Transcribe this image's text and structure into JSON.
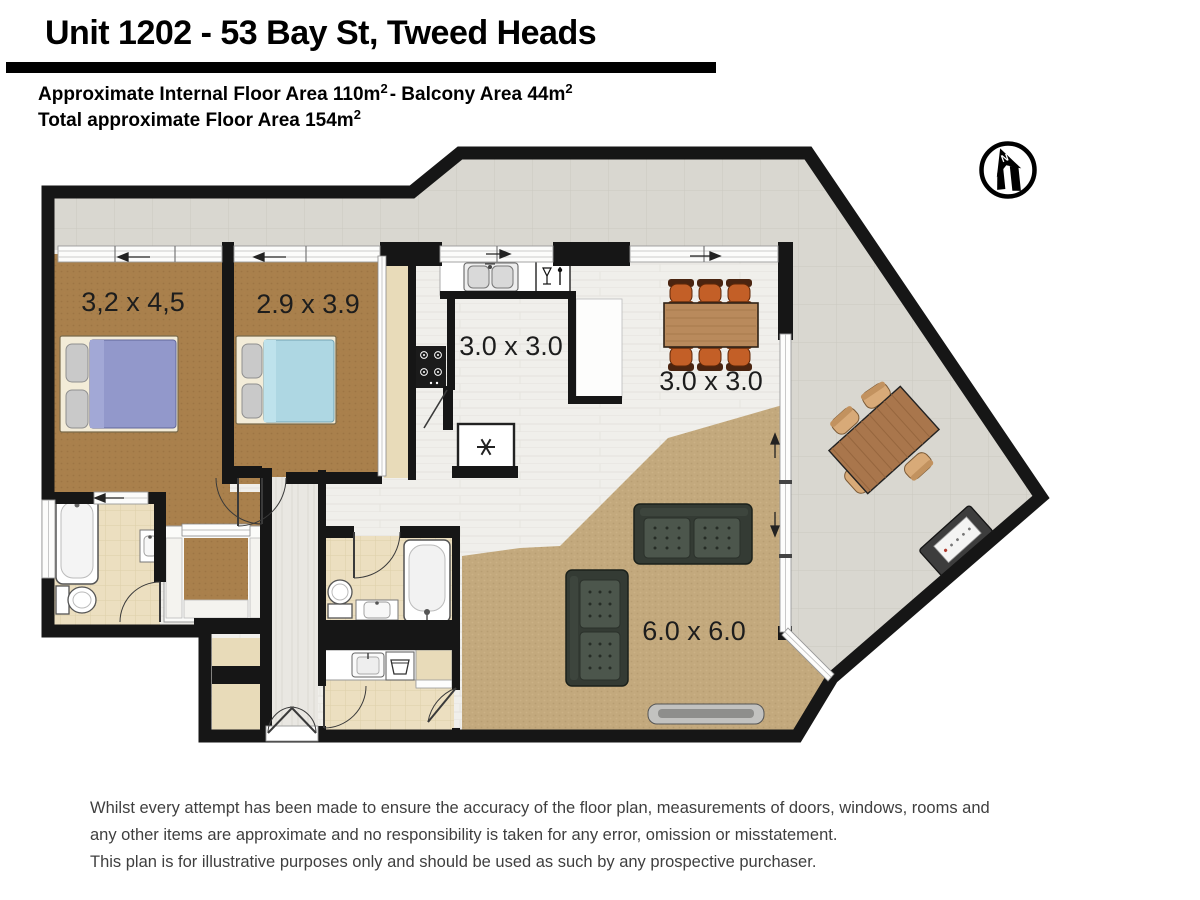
{
  "header": {
    "title": "Unit 1202 - 53 Bay St, Tweed Heads",
    "area_line1": {
      "text": "Approximate Internal Floor Area 110m",
      "sup": "2",
      "text2": "- Balcony Area 44m",
      "sup2": "2"
    },
    "area_line2": {
      "text": "Total approximate Floor Area 154m",
      "sup": "2"
    }
  },
  "plan": {
    "compass_label": "N",
    "rooms": [
      {
        "id": "bedroom-1",
        "label": "3,2 x 4,5"
      },
      {
        "id": "bedroom-2",
        "label": "2.9 x 3.9"
      },
      {
        "id": "kitchen",
        "label": "3.0 x 3.0"
      },
      {
        "id": "dining",
        "label": "3.0 x 3.0"
      },
      {
        "id": "living",
        "label": "6.0 x 6.0"
      }
    ]
  },
  "footer": {
    "disclaimer_lines": [
      "Whilst every attempt has been made to ensure the accuracy of the floor plan, measurements of doors, windows, rooms and",
      "any other items are approximate and no responsibility is taken for any error, omission or misstatement.",
      "This plan is for illustrative purposes only and should be used as such by any prospective purchaser."
    ]
  },
  "colors": {
    "wall": "#161616",
    "balcony_tile": "#d9d7d0",
    "carpet_bedroom": "#a9804c",
    "carpet_living": "#c3a97d",
    "tile_cream": "#ecdfc0",
    "bed1_linen": "#9298cb",
    "bed2_linen": "#aed7e3",
    "dining_chair": "#c35f27"
  }
}
